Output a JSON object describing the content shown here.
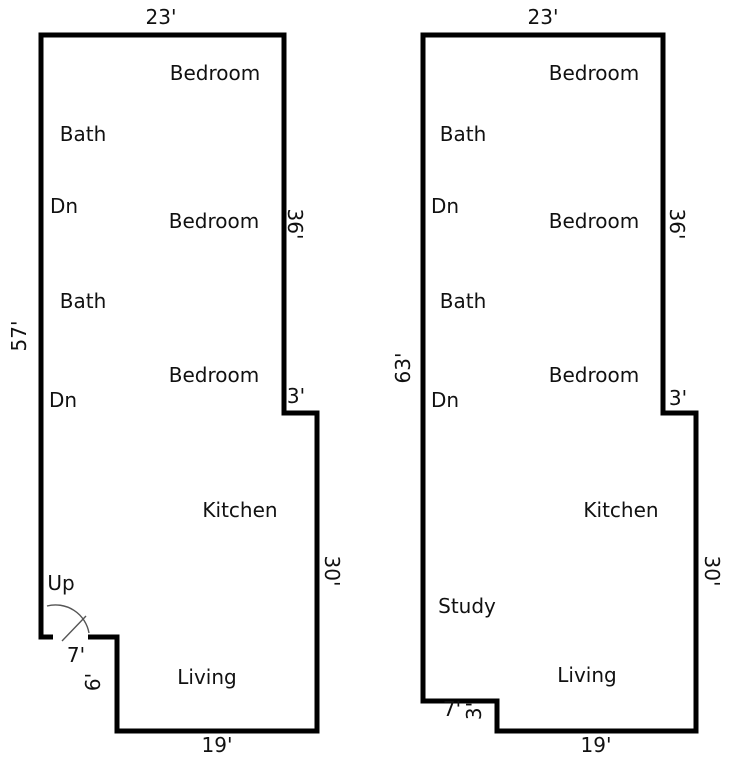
{
  "left_plan": {
    "dims": {
      "top": "23'",
      "left": "57'",
      "right_upper": "36'",
      "step": "3'",
      "right_lower": "30'",
      "bottom": "19'",
      "notch_width": "7'",
      "notch_height": "6'"
    },
    "rooms": {
      "bedroom_top": "Bedroom",
      "bath_upper": "Bath",
      "stairs_down_upper": "Dn",
      "bedroom_middle": "Bedroom",
      "bath_lower": "Bath",
      "bedroom_lower": "Bedroom",
      "stairs_down_lower": "Dn",
      "kitchen": "Kitchen",
      "stairs_up": "Up",
      "living": "Living"
    }
  },
  "right_plan": {
    "dims": {
      "top": "23'",
      "left": "63'",
      "right_upper": "36'",
      "step": "3'",
      "right_lower": "30'",
      "bottom": "19'",
      "notch_width": "7'",
      "notch_height": "3'"
    },
    "rooms": {
      "bedroom_top": "Bedroom",
      "bath_upper": "Bath",
      "stairs_down_upper": "Dn",
      "bedroom_middle": "Bedroom",
      "bath_lower": "Bath",
      "bedroom_lower": "Bedroom",
      "stairs_down_lower": "Dn",
      "kitchen": "Kitchen",
      "study": "Study",
      "living": "Living"
    }
  }
}
